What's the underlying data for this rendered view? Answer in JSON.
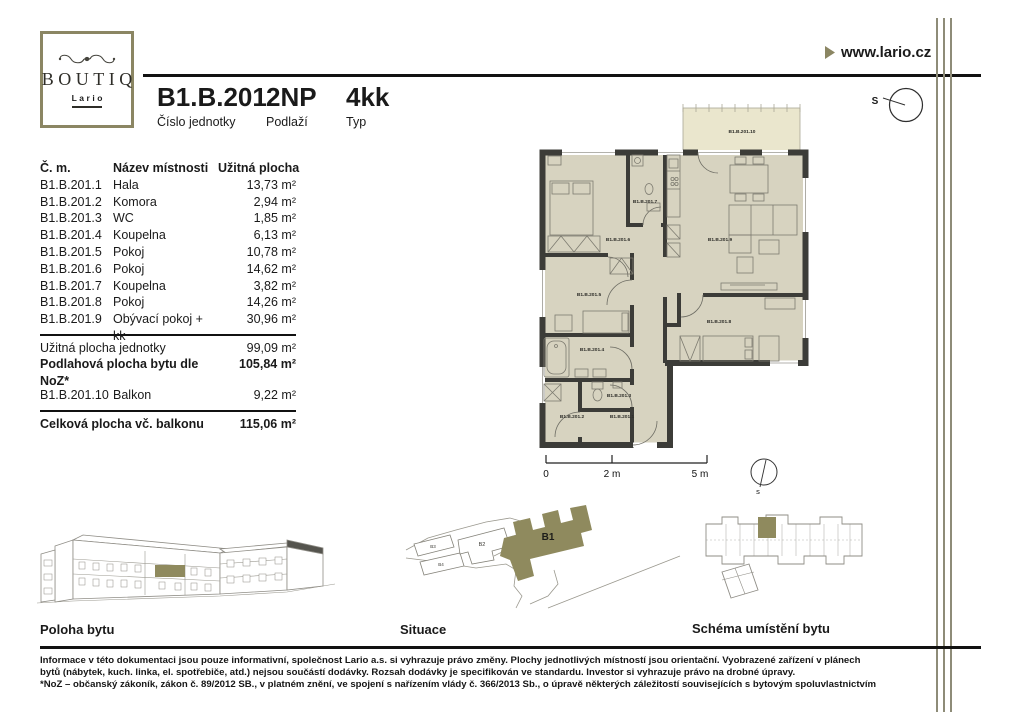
{
  "brand": {
    "name": "BOUTIQ",
    "sub": "Lario",
    "website": "www.lario.cz"
  },
  "header": {
    "unit": "B1.B.201",
    "unit_label": "Číslo jednotky",
    "floor": "2NP",
    "floor_label": "Podlaží",
    "type": "4kk",
    "type_label": "Typ"
  },
  "table": {
    "col_number": "Č. m.",
    "col_name": "Název místnosti",
    "col_area": "Užitná plocha",
    "rooms": [
      {
        "number": "B1.B.201.1",
        "name": "Hala",
        "area": "13,73 m²"
      },
      {
        "number": "B1.B.201.2",
        "name": "Komora",
        "area": "2,94 m²"
      },
      {
        "number": "B1.B.201.3",
        "name": "WC",
        "area": "1,85 m²"
      },
      {
        "number": "B1.B.201.4",
        "name": "Koupelna",
        "area": "6,13 m²"
      },
      {
        "number": "B1.B.201.5",
        "name": "Pokoj",
        "area": "10,78 m²"
      },
      {
        "number": "B1.B.201.6",
        "name": "Pokoj",
        "area": "14,62 m²"
      },
      {
        "number": "B1.B.201.7",
        "name": "Koupelna",
        "area": "3,82 m²"
      },
      {
        "number": "B1.B.201.8",
        "name": "Pokoj",
        "area": "14,26 m²"
      },
      {
        "number": "B1.B.201.9",
        "name": "Obývací pokoj + kk",
        "area": "30,96 m²"
      }
    ],
    "usable_label": "Užitná plocha jednotky",
    "usable_value": "99,09 m²",
    "noz_label": "Podlahová plocha bytu dle NoZ*",
    "noz_value": "105,84 m²",
    "balcony_number": "B1.B.201.10",
    "balcony_name": "Balkon",
    "balcony_area": "9,22 m²",
    "total_label": "Celková plocha vč. balkonu",
    "total_value": "115,06 m²"
  },
  "plan": {
    "labels": {
      "r1": "B1.B.201.1",
      "r2": "B1.B.201.2",
      "r3": "B1.B.201.3",
      "r4": "B1.B.201.4",
      "r5": "B1.B.201.5",
      "r6": "B1.B.201.6",
      "r7": "B1.B.201.7",
      "r8": "B1.B.201.8",
      "r9": "B1.B.201.9",
      "r10": "B1.B.201.10"
    },
    "scale": {
      "zero": "0",
      "two": "2 m",
      "five": "5 m"
    },
    "compass_top": "S",
    "compass_bottom": "s"
  },
  "sections": {
    "poloha": "Poloha bytu",
    "situace": "Situace",
    "schema": "Schéma umístění bytu"
  },
  "site": {
    "b1": "B1",
    "b2": "B2",
    "b3": "B3",
    "b4": "B4"
  },
  "footer": {
    "lines": [
      "Informace v této dokumentaci jsou pouze informativní, společnost Lario a.s. si vyhrazuje právo změny. Plochy jednotlivých místností jsou orientační. Vyobrazené zařízení v plánech",
      "bytů (nábytek, kuch. linka, el. spotřebiče, atd.) nejsou součástí dodávky. Rozsah dodávky je specifikován ve standardu. Investor si vyhrazuje právo na drobné úpravy.",
      "*NoZ – občanský zákoník, zákon č. 89/2012 SB., v platném znění, ve spojení s nařízením vlády č. 366/2013 Sb., o úpravě některých záležitostí souvisejících s bytovým spoluvlastnictvím"
    ]
  },
  "colors": {
    "accent": "#8b8663",
    "room_fill": "#d7d3c0",
    "balcony_fill": "#eae6cd",
    "wall": "#3c3c38"
  }
}
